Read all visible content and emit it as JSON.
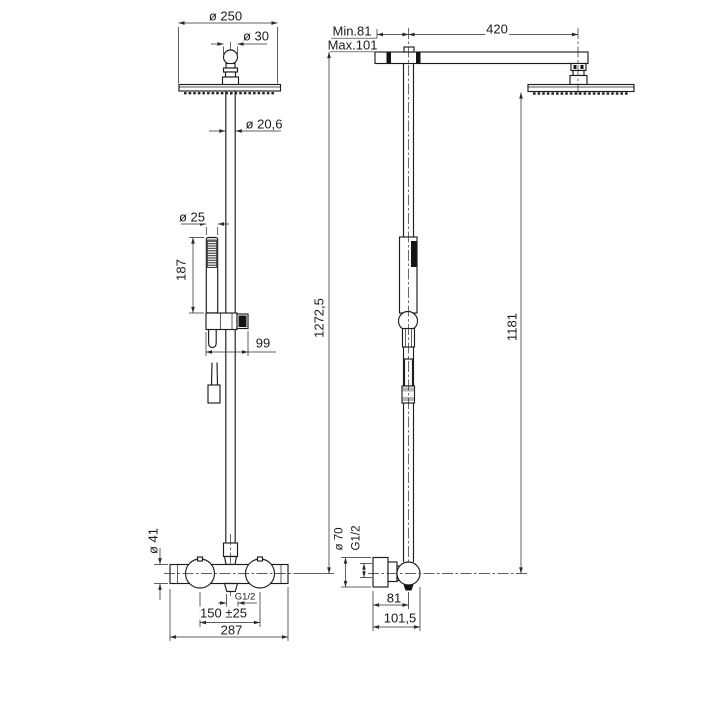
{
  "drawing": {
    "front_view": {
      "head_diameter": "ø 250",
      "ball_joint_diameter": "ø 30",
      "riser_pipe_diameter": "ø 20,6",
      "hand_shower_diameter": "ø 25",
      "hand_shower_length": "187",
      "slider_bracket_width": "99",
      "valve_body_diameter": "ø 41",
      "outlet_thread": "G1/2",
      "supply_spacing": "150 ±25",
      "valve_width": "287",
      "total_height": "1272,5"
    },
    "side_view": {
      "wall_distance_min": "Min.81",
      "wall_distance_max": "Max.101",
      "arm_length": "420",
      "head_plate_height": "1181",
      "escutcheon_diameter": "ø 70",
      "inlet_thread": "G1/2",
      "wall_to_pipe_center": "81",
      "wall_to_handle_front": "101,5"
    },
    "colors": {
      "line": "#1d1d1f",
      "dimension": "#2b2b2b",
      "background": "#ffffff",
      "dark_fill": "#141414",
      "gray_fill": "#b3b3b3"
    }
  }
}
